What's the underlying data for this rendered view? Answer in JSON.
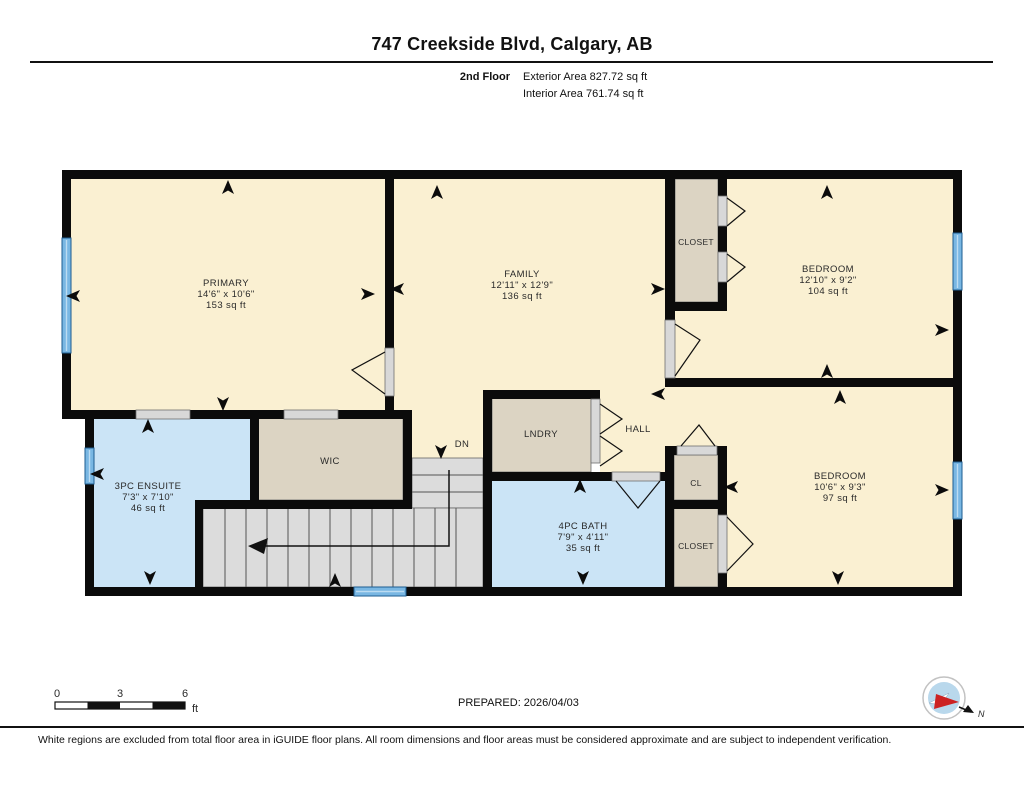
{
  "header": {
    "title": "747 Creekside Blvd, Calgary, AB",
    "floor_label": "2nd Floor",
    "exterior_area": "Exterior Area 827.72 sq ft",
    "interior_area": "Interior Area 761.74 sq ft"
  },
  "rooms": {
    "primary": {
      "name": "PRIMARY",
      "dims": "14'6\" x 10'6\"",
      "area": "153 sq ft"
    },
    "family": {
      "name": "FAMILY",
      "dims": "12'11\" x 12'9\"",
      "area": "136 sq ft"
    },
    "bedroom_top": {
      "name": "BEDROOM",
      "dims": "12'10\" x 9'2\"",
      "area": "104 sq ft"
    },
    "bedroom_bottom": {
      "name": "BEDROOM",
      "dims": "10'6\" x 9'3\"",
      "area": "97 sq ft"
    },
    "ensuite": {
      "name": "3PC ENSUITE",
      "dims": "7'3\" x 7'10\"",
      "area": "46 sq ft"
    },
    "bath": {
      "name": "4PC BATH",
      "dims": "7'9\" x 4'11\"",
      "area": "35 sq ft"
    },
    "wic": {
      "name": "WIC"
    },
    "laundry": {
      "name": "LNDRY"
    },
    "hall": {
      "name": "HALL"
    },
    "closet_top": {
      "name": "CLOSET"
    },
    "closet_small": {
      "name": "CL"
    },
    "closet_bottom": {
      "name": "CLOSET"
    },
    "stairs": {
      "down_label": "DN"
    }
  },
  "footer": {
    "scale_ticks": [
      "0",
      "3",
      "6"
    ],
    "scale_unit": "ft",
    "prepared": "PREPARED: 2026/04/03",
    "compass_north": "N",
    "disclaimer": "White regions are excluded from total floor area in iGUIDE floor plans. All room dimensions and floor areas must be considered approximate and are subject to independent verification."
  },
  "colors": {
    "room_fill": "#faf0d2",
    "wet_room_fill": "#cbe4f6",
    "closet_fill": "#dcd4c3",
    "stairs_fill": "#dcdcdc",
    "wall": "#0b0b0b",
    "window": "#79b7e3"
  }
}
